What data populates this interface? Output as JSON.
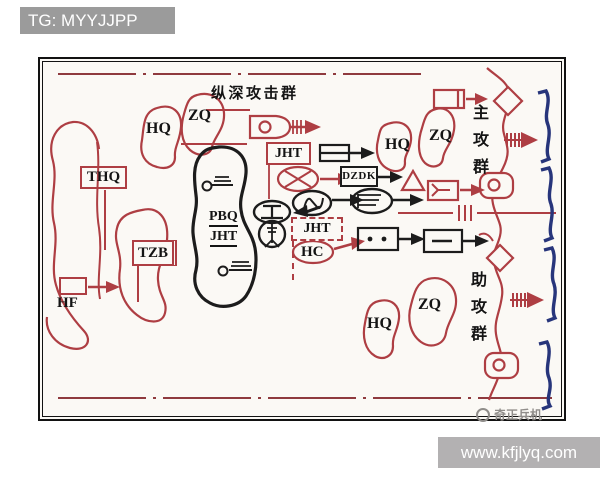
{
  "banner": {
    "text": "TG: MYYJJPP"
  },
  "watermark": {
    "site": "www.kfjlyq.com",
    "logo": "奇正兵机"
  },
  "groups": {
    "deep_attack": "纵深攻击群",
    "main_attack": "主攻群",
    "assist_attack": "助攻群"
  },
  "labels": {
    "thq": "THQ",
    "tzb": "TZB",
    "hf": "HF",
    "hq": "HQ",
    "zq": "ZQ",
    "jht": "JHT",
    "pbq": "PBQ",
    "hc": "HC",
    "dzdk": "DZDK"
  },
  "colors": {
    "friendly_red": "#ae3e43",
    "boundary_red": "#8f3a3e",
    "unit_black": "#1c1c1c",
    "enemy_blue": "#27357b",
    "paper": "#fbf9f5",
    "banner_bg": "#9b9b9b",
    "sitebar_bg": "#b3b1b2"
  }
}
